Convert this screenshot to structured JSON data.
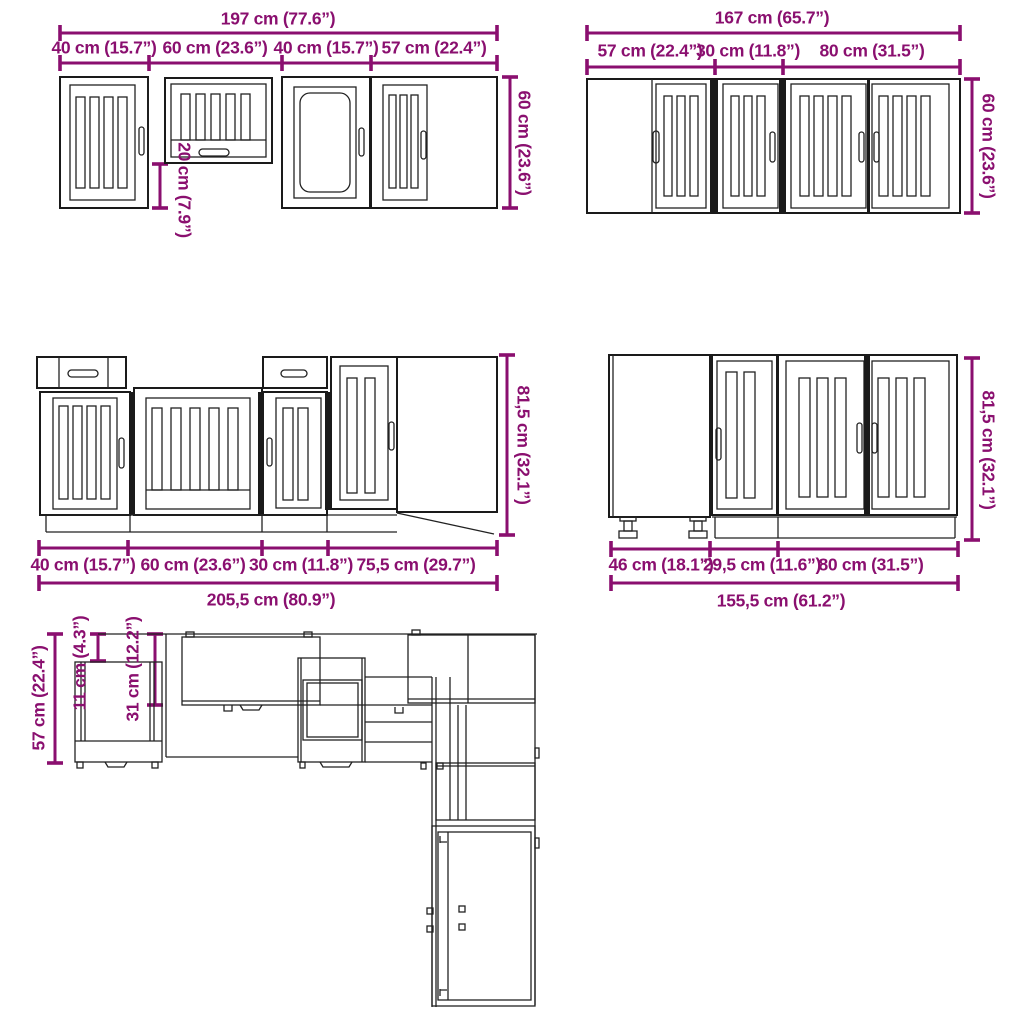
{
  "colors": {
    "dimension_accent": "#8A0F6F",
    "drawing_line": "#222222",
    "background": "#ffffff"
  },
  "drawings": {
    "wall_cabinets_left": {
      "name": "wall cabinet run A - front view",
      "total_width": "197 cm (77.6”)",
      "sections": [
        "40 cm (15.7”)",
        "60 cm (23.6”)",
        "40 cm (15.7”)",
        "57 cm (22.4”)"
      ],
      "height": "60 cm (23.6”)",
      "drop_height": "20 cm (7.9”)"
    },
    "wall_cabinets_right": {
      "name": "wall cabinet run B - front view",
      "total_width": "167 cm (65.7”)",
      "sections": [
        "57 cm (22.4”)",
        "30 cm (11.8”)",
        "80 cm (31.5”)"
      ],
      "height": "60 cm (23.6”)"
    },
    "base_cabinets_left": {
      "name": "base cabinet run A - front view",
      "sections": [
        "40 cm (15.7”)",
        "60 cm (23.6”)",
        "30 cm (11.8”)",
        "75,5 cm (29.7”)"
      ],
      "total_width": "205,5 cm (80.9”)",
      "height": "81,5 cm (32.1”)"
    },
    "base_cabinets_right": {
      "name": "base cabinet run B - front view",
      "sections": [
        "46 cm (18.1”)",
        "29,5 cm (11.6”)",
        "80 cm (31.5”)"
      ],
      "total_width": "155,5 cm (61.2”)",
      "height": "81,5 cm (32.1”)"
    },
    "plan_view": {
      "name": "L-shaped kitchen - top plan view",
      "counter_depth": "57 cm (22.4”)",
      "upper_gap_depth": "11 cm (4.3”)",
      "wall_cabinet_depth": "31 cm (12.2”)"
    }
  }
}
